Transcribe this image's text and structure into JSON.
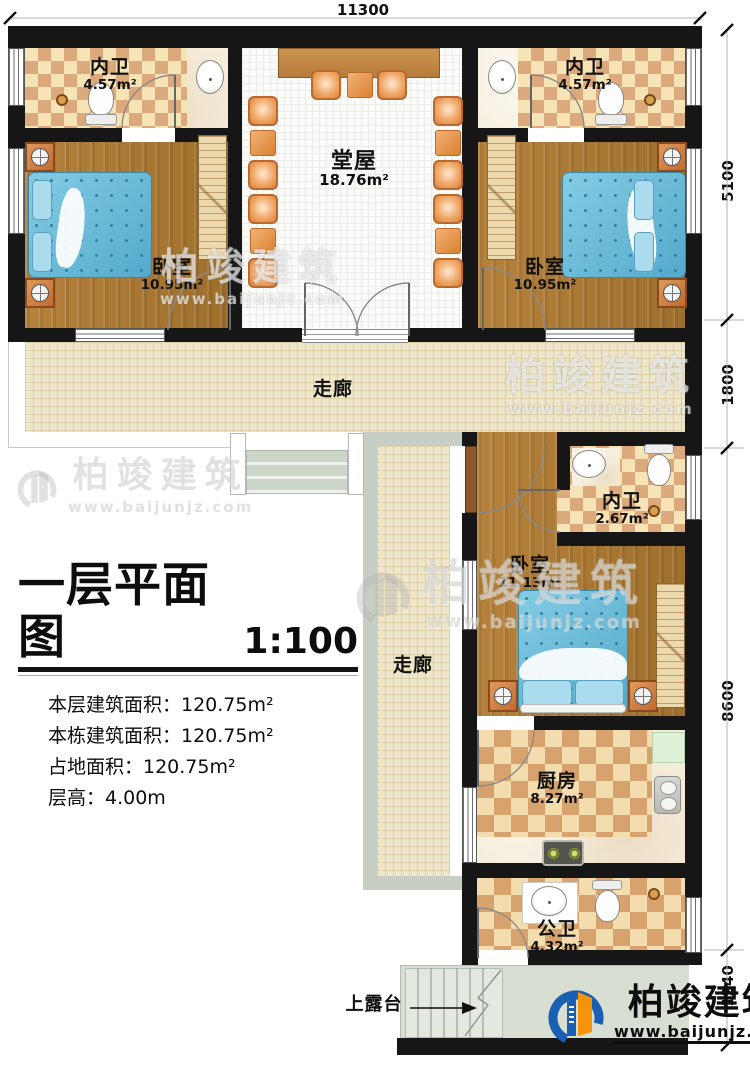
{
  "dimensions": {
    "top": "11300",
    "right": [
      "5100",
      "1800",
      "8600",
      "1240"
    ]
  },
  "rooms": {
    "bath_tl": {
      "name": "内卫",
      "area": "4.57m²"
    },
    "bath_tr": {
      "name": "内卫",
      "area": "4.57m²"
    },
    "hall": {
      "name": "堂屋",
      "area": "18.76m²"
    },
    "bedroom_left": {
      "name": "卧室",
      "area": "10.95m²"
    },
    "bedroom_right": {
      "name": "卧室",
      "area": "10.95m²"
    },
    "corridor_h": {
      "name": "走廊"
    },
    "corridor_v": {
      "name": "走廊"
    },
    "bath_mid": {
      "name": "内卫",
      "area": "2.67m²"
    },
    "bedroom_mid": {
      "name": "卧室",
      "area": "11.13m²"
    },
    "kitchen": {
      "name": "厨房",
      "area": "8.27m²"
    },
    "bath_public": {
      "name": "公卫",
      "area": "4.32m²"
    },
    "terrace": {
      "name": "上露台"
    }
  },
  "title_block": {
    "title": "一层平面图",
    "scale": "1:100",
    "lines": [
      "本层建筑面积：120.75m²",
      "本栋建筑面积：120.75m²",
      "占地面积：120.75m²",
      "层高：4.00m"
    ]
  },
  "brand": {
    "name": "柏竣建筑",
    "url": "www.baijunjz.com"
  },
  "colors": {
    "wall": "#161616",
    "wood": "#a9772f",
    "bed": "#66bcd9",
    "logo_blue": "#1a5fb4",
    "logo_orange": "#f5930a"
  }
}
